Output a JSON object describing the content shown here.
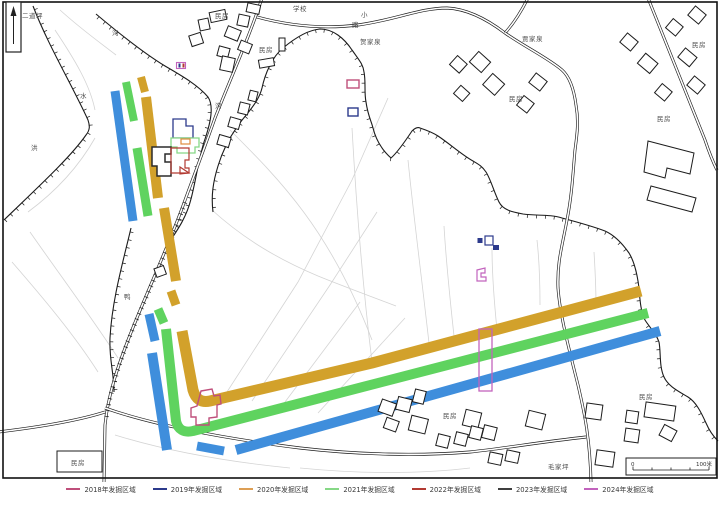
{
  "colors": {
    "y2018": "#bf4f7b",
    "y2019": "#2c3a8c",
    "y2020": "#dd9f55",
    "y2021": "#86d886",
    "y2022": "#b23a32",
    "y2023": "#3f3f3f",
    "y2024": "#c263bd",
    "band_blue": "#3f8edc",
    "band_green": "#5fd35f",
    "band_yellow": "#d2a12b",
    "outline_orange": "#e08a3c",
    "road_black": "#1c1c1c"
  },
  "legend": {
    "items": [
      {
        "label": "2018年发掘区域",
        "color": "y2018"
      },
      {
        "label": "2019年发掘区域",
        "color": "y2019"
      },
      {
        "label": "2020年发掘区域",
        "color": "y2020"
      },
      {
        "label": "2021年发掘区域",
        "color": "y2021"
      },
      {
        "label": "2022年发掘区域",
        "color": "y2022"
      },
      {
        "label": "2023年发掘区域",
        "color": "y2023"
      },
      {
        "label": "2024年发掘区域",
        "color": "y2024"
      }
    ]
  },
  "map": {
    "labels": [
      {
        "text": "二道坪",
        "x": 22,
        "y": 10
      },
      {
        "text": "沟",
        "x": 112,
        "y": 27
      },
      {
        "text": "水",
        "x": 80,
        "y": 90
      },
      {
        "text": "洪",
        "x": 31,
        "y": 142
      },
      {
        "text": "民房",
        "x": 215,
        "y": 10
      },
      {
        "text": "学校",
        "x": 293,
        "y": 3
      },
      {
        "text": "小",
        "x": 361,
        "y": 9
      },
      {
        "text": "路",
        "x": 352,
        "y": 19
      },
      {
        "text": "民房",
        "x": 259,
        "y": 44
      },
      {
        "text": "贺家泉",
        "x": 360,
        "y": 36
      },
      {
        "text": "贾家泉",
        "x": 522,
        "y": 33
      },
      {
        "text": "民房",
        "x": 692,
        "y": 39
      },
      {
        "text": "民房",
        "x": 509,
        "y": 93
      },
      {
        "text": "民房",
        "x": 657,
        "y": 113
      },
      {
        "text": "沟",
        "x": 215,
        "y": 100
      },
      {
        "text": "鸭",
        "x": 124,
        "y": 291
      },
      {
        "text": "民房",
        "x": 443,
        "y": 410
      },
      {
        "text": "民房",
        "x": 639,
        "y": 391
      },
      {
        "text": "毛家坪",
        "x": 548,
        "y": 461
      },
      {
        "text": "民房",
        "x": 71,
        "y": 457
      }
    ],
    "scale_bar": {
      "zero": "0",
      "max": "100米"
    }
  }
}
